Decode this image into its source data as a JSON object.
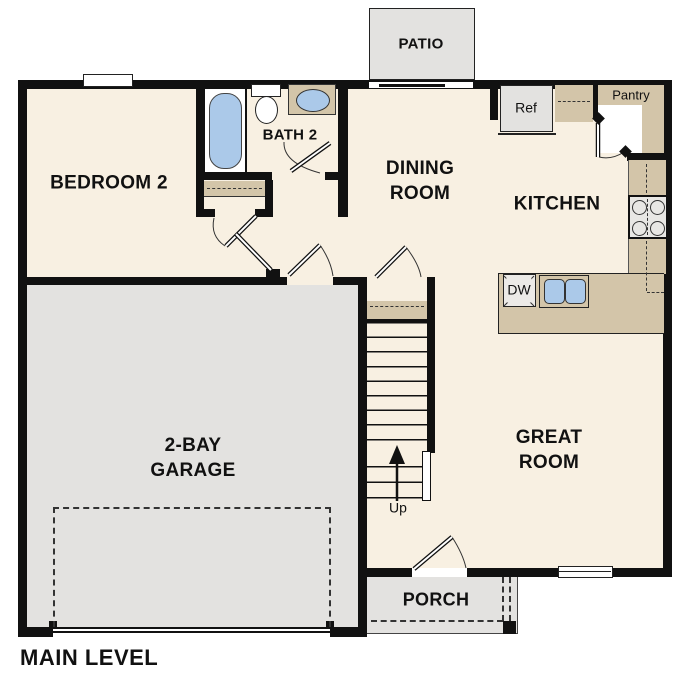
{
  "plan": {
    "title": "MAIN LEVEL",
    "rooms": {
      "bedroom2": "BEDROOM 2",
      "bath2": "BATH 2",
      "dining": "DINING ROOM",
      "kitchen": "KITCHEN",
      "great_room": "GREAT ROOM",
      "garage": "2-BAY GARAGE"
    },
    "outdoor": {
      "patio": "PATIO",
      "porch": "PORCH"
    },
    "storage": {
      "pantry": "Pantry"
    },
    "appliances": {
      "refrigerator": "Ref",
      "dishwasher": "DW"
    },
    "stairs": {
      "direction": "Up"
    },
    "colors": {
      "floor": "#f8f0e2",
      "counter": "#d3c5a9",
      "garage": "#e3e2e0",
      "fixture": "#abc9e9",
      "wall": "#111111"
    }
  }
}
